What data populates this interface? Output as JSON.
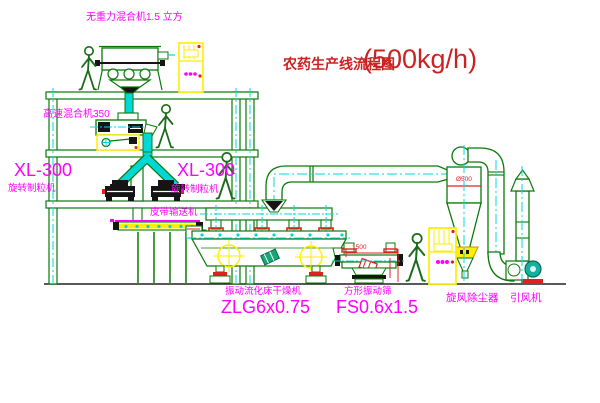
{
  "title": {
    "text": "农药生产线流程图",
    "capacity": "(500kg/h)"
  },
  "labels": {
    "gravity_mixer": "无重力混合机1.5 立方",
    "mixer_350": "高速混合机350",
    "granulator_left_model": "XL-300",
    "granulator_left_name": "旋转制粒机",
    "granulator_right_model": "XL-300",
    "granulator_right_name": "旋转制粒机",
    "belt_conveyor": "皮带输送机",
    "dryer_name": "振动流化床干燥机",
    "dryer_model": "ZLG6x0.75",
    "sieve_name": "方形振动筛",
    "sieve_model": "FS0.6x1.5",
    "cyclone": "旋风除尘器",
    "induced_fan": "引风机"
  },
  "dimensions": {
    "cyclone_diameter": "Ø500",
    "sieve_length": "1500"
  },
  "colors": {
    "label_magenta": "#ff00ff",
    "title_red": "#cc2222",
    "structure_green": "#0a7a0a",
    "centerline_cyan": "#00d8d8",
    "highlight_yellow": "#ffee00",
    "dimension_red": "#e02020"
  }
}
